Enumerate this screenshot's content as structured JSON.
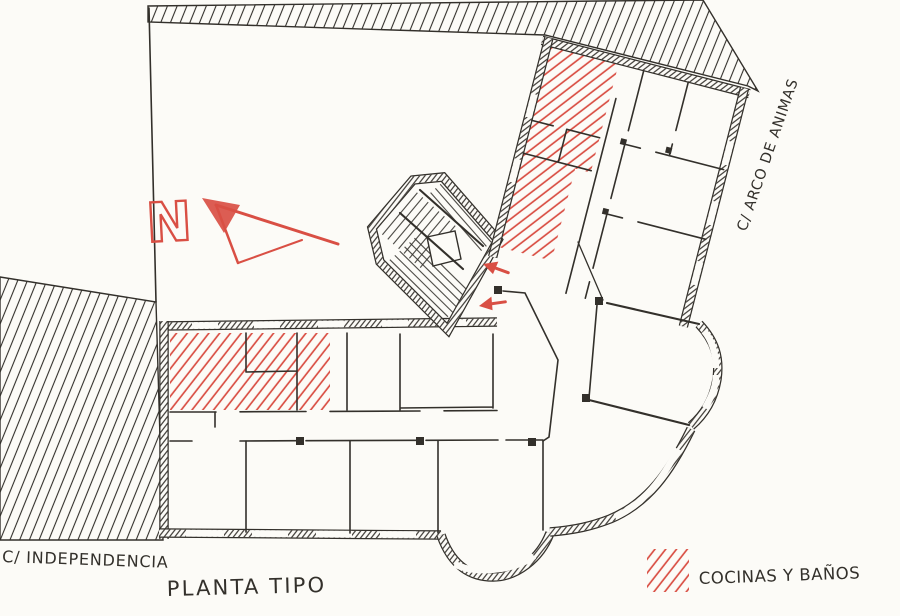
{
  "plan": {
    "title": "PLANTA TIPO",
    "streets": {
      "bottom": "C/ INDEPENDENCIA",
      "right": "C/ ARCO DE ANIMAS"
    },
    "compass": {
      "label": "N"
    },
    "legend": {
      "items": [
        {
          "label": "COCINAS Y BAÑOS",
          "swatch": "red-diagonal-hatch"
        }
      ]
    },
    "colors": {
      "paper": "#fcfbf7",
      "ink": "#33302b",
      "red": "#d94f44"
    }
  }
}
